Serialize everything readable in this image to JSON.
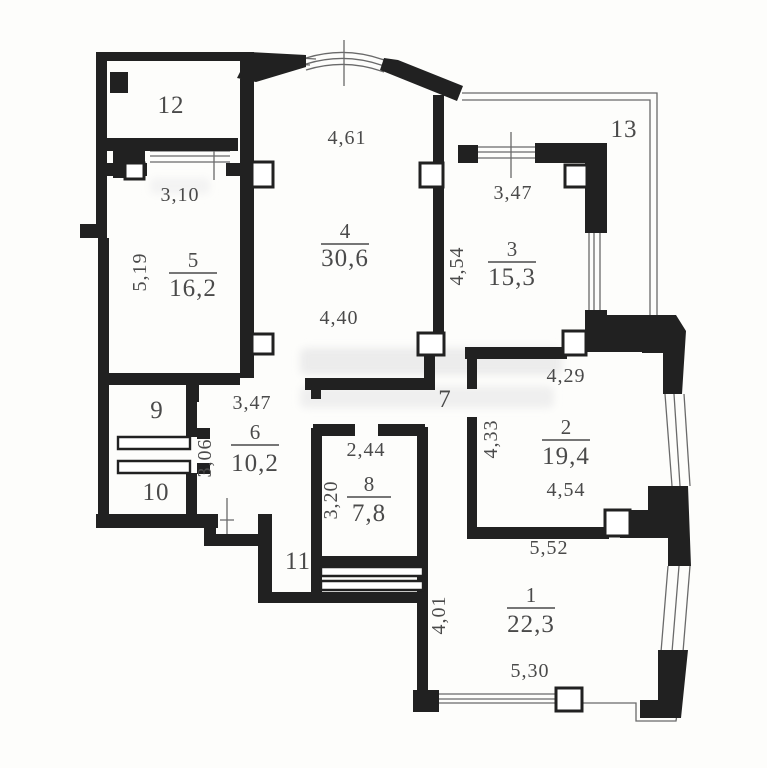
{
  "plan": {
    "rooms": {
      "r1": {
        "number": "1",
        "area": "22,3"
      },
      "r2": {
        "number": "2",
        "area": "19,4"
      },
      "r3": {
        "number": "3",
        "area": "15,3"
      },
      "r4": {
        "number": "4",
        "area": "30,6"
      },
      "r5": {
        "number": "5",
        "area": "16,2"
      },
      "r6": {
        "number": "6",
        "area": "10,2"
      },
      "r8": {
        "number": "8",
        "area": "7,8"
      }
    },
    "labels": {
      "room7": "7",
      "room9": "9",
      "room10": "10",
      "room11": "11",
      "room12": "12",
      "room13": "13"
    },
    "dimensions": {
      "d310": "3,10",
      "d461": "4,61",
      "d347_top": "3,47",
      "d519": "5,19",
      "d454_mid": "4,54",
      "d440": "4,40",
      "d347_mid": "3,47",
      "d429": "4,29",
      "d433": "4,33",
      "d244": "2,44",
      "d306": "3,06",
      "d320": "3,20",
      "d454_low": "4,54",
      "d552": "5,52",
      "d401": "4,01",
      "d530": "5,30"
    }
  },
  "colors": {
    "wall": "#212121",
    "thin_line": "#6a6a6a",
    "text": "#4a4a4a",
    "background": "#fdfdfb",
    "watermark": "#ececec"
  }
}
